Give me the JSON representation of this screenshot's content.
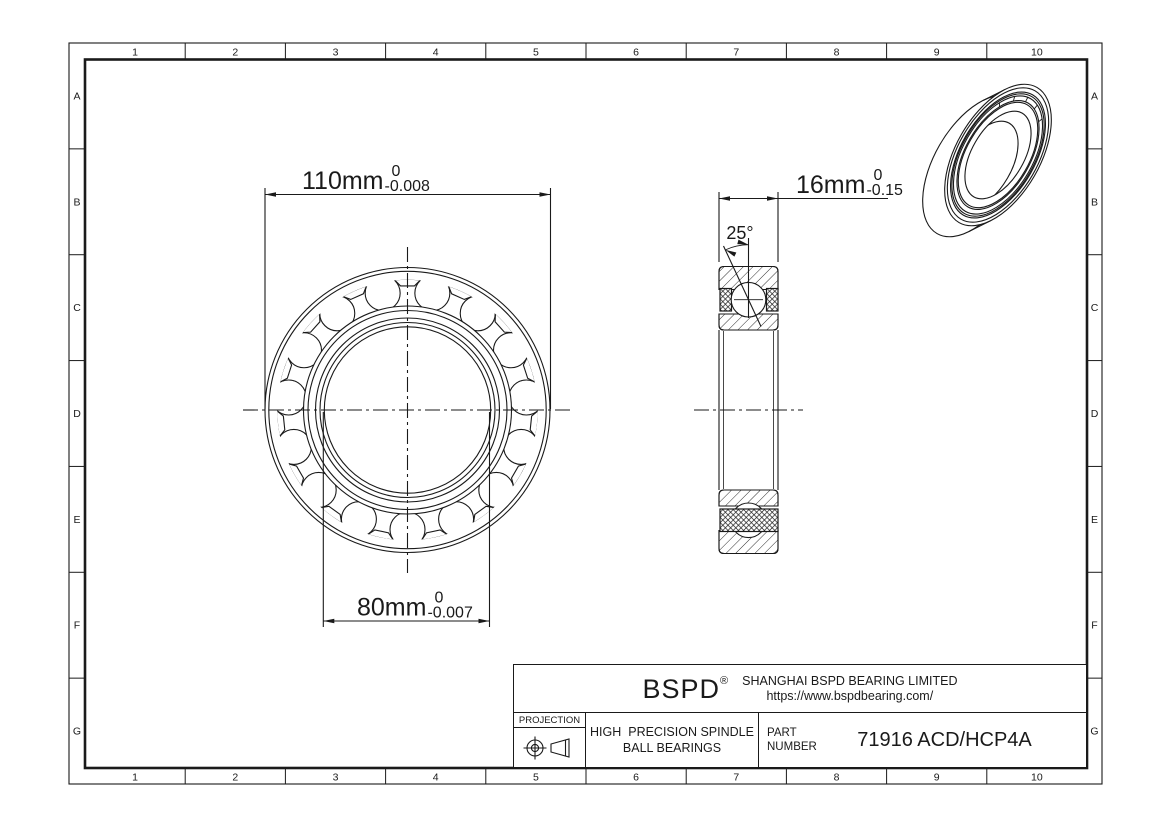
{
  "sheet": {
    "zone_columns": [
      "1",
      "2",
      "3",
      "4",
      "5",
      "6",
      "7",
      "8",
      "9",
      "10"
    ],
    "zone_rows": [
      "A",
      "B",
      "C",
      "D",
      "E",
      "F",
      "G"
    ]
  },
  "dimensions": {
    "outer_diameter": {
      "value": "110mm",
      "tol_upper": "0",
      "tol_lower": "-0.008"
    },
    "bore_diameter": {
      "value": "80mm",
      "tol_upper": "0",
      "tol_lower": "-0.007"
    },
    "width": {
      "value": "16mm",
      "tol_upper": "0",
      "tol_lower": "-0.15"
    },
    "contact_angle": {
      "value": "25°"
    }
  },
  "title_block": {
    "logo": "BSPD",
    "logo_mark": "®",
    "company": "SHANGHAI BSPD BEARING LIMITED",
    "website": "https://www.bspdbearing.com/",
    "projection_label": "PROJECTION",
    "product_line1": "HIGH  PRECISION SPINDLE",
    "product_line2": "BALL BEARINGS",
    "part_label_line1": "PART",
    "part_label_line2": "NUMBER",
    "part_number": "71916 ACD/HCP4A"
  },
  "colors": {
    "ink": "#1a1a1a",
    "paper": "#ffffff"
  }
}
